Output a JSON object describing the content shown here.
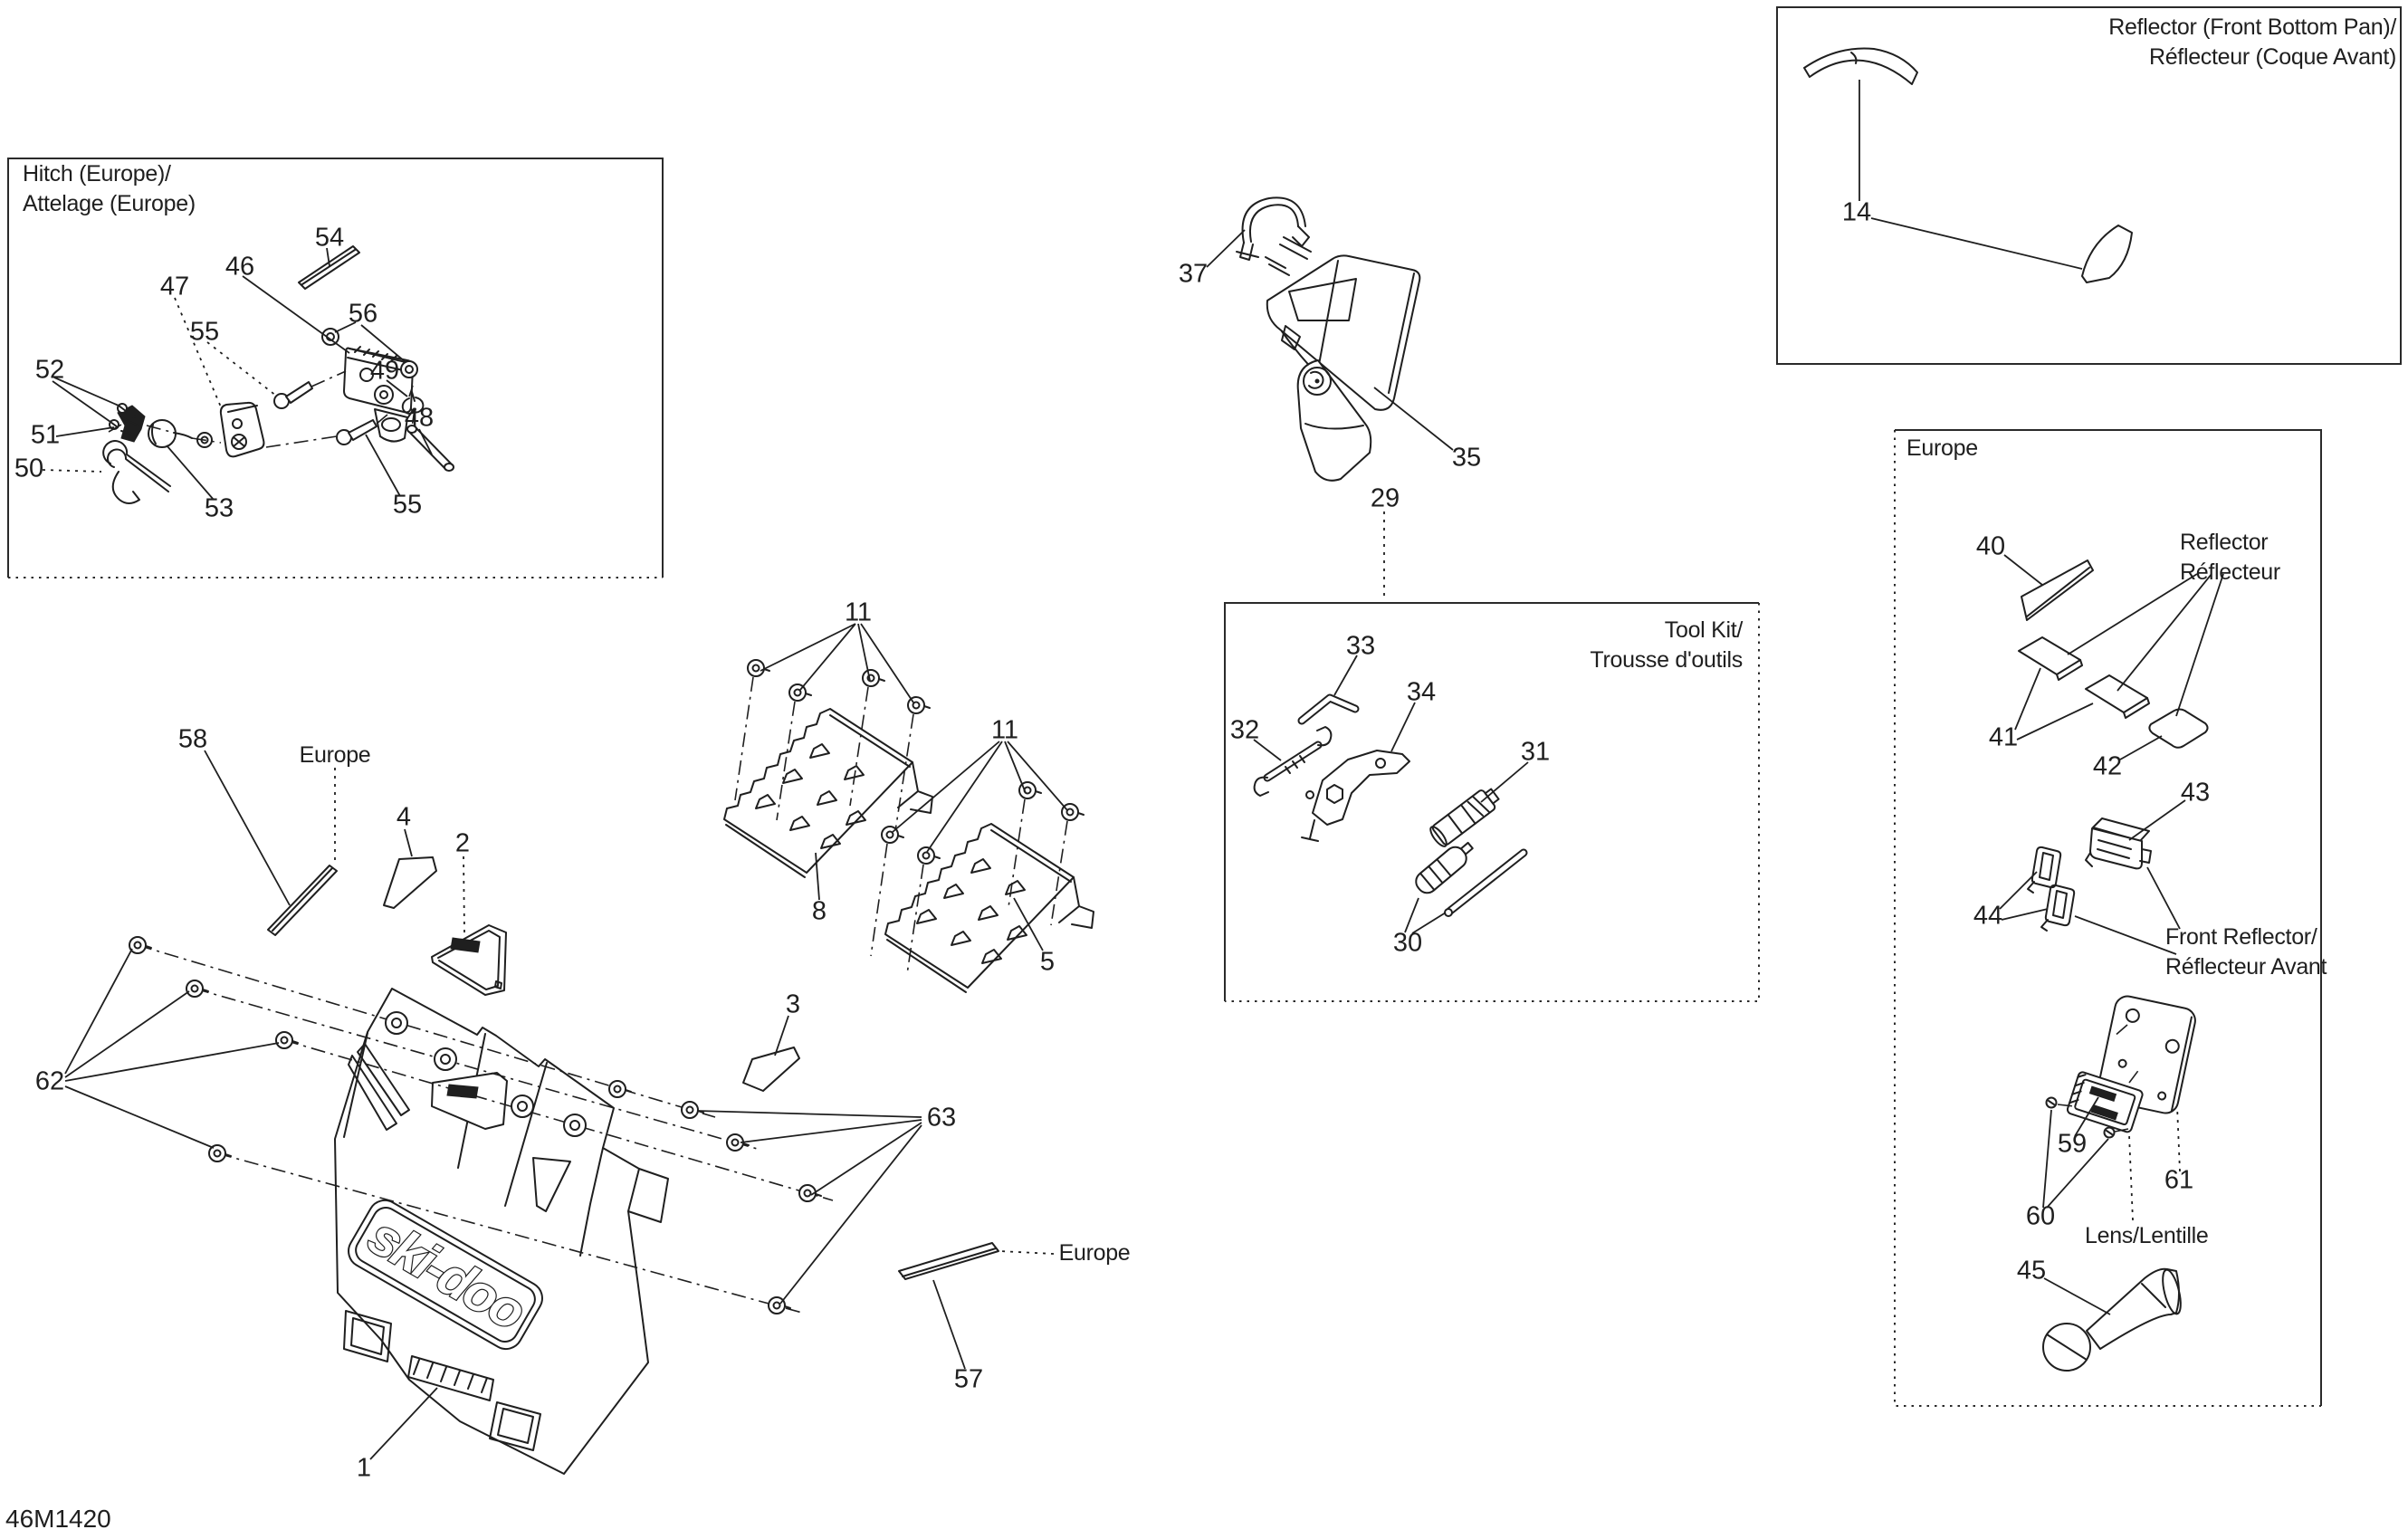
{
  "page": {
    "code": "46M1420"
  },
  "boxes": {
    "hitch": {
      "line1": "Hitch (Europe)/",
      "line2": "Attelage (Europe)"
    },
    "front_pan_reflector": {
      "line1": "Reflector (Front Bottom Pan)/",
      "line2": "Réflecteur (Coque Avant)"
    },
    "tool_kit": {
      "line1": "Tool Kit/",
      "line2": "Trousse d'outils"
    },
    "europe": {
      "title": "Europe"
    }
  },
  "labels": {
    "europe_strip_left": "Europe",
    "europe_strip_mid": "Europe",
    "reflector_1": "Reflector",
    "reflector_2": "Réflecteur",
    "front_reflector_1": "Front Reflector/",
    "front_reflector_2": "Réflecteur Avant",
    "lens": "Lens/Lentille",
    "logo": "ski-doo"
  },
  "callouts": {
    "c1": "1",
    "c2": "2",
    "c3": "3",
    "c4": "4",
    "c5": "5",
    "c8": "8",
    "c11a": "11",
    "c11b": "11",
    "c14": "14",
    "c29": "29",
    "c30": "30",
    "c31": "31",
    "c32": "32",
    "c33": "33",
    "c34": "34",
    "c35": "35",
    "c37": "37",
    "c40": "40",
    "c41": "41",
    "c42": "42",
    "c43": "43",
    "c44": "44",
    "c45": "45",
    "c46": "46",
    "c47": "47",
    "c48": "48",
    "c49": "49",
    "c50": "50",
    "c51": "51",
    "c52": "52",
    "c53": "53",
    "c54": "54",
    "c55a": "55",
    "c55b": "55",
    "c56": "56",
    "c57": "57",
    "c58": "58",
    "c59": "59",
    "c60": "60",
    "c61": "61",
    "c62": "62",
    "c63": "63"
  }
}
